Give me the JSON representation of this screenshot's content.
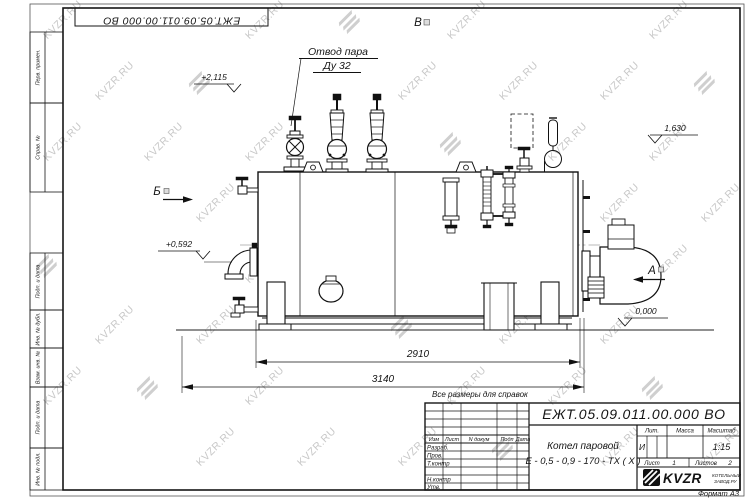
{
  "document": {
    "designation": "ЕЖТ.05.09.011.00.000  ВО",
    "product_name_line1": "Котел паровой",
    "product_name_line2": "Е - 0,5 - 0,9 - 170 -  ТХ ( Х )",
    "reference_note": "Все размеры для справок",
    "format_label": "Формат А3",
    "liter": "И",
    "scale": "1:15",
    "sheet_label": "Лист",
    "sheet_value": "1",
    "sheets_label": "Листов",
    "sheets_value": "2"
  },
  "title_block": {
    "lit_header": "Лит.",
    "mass_header": "Масса",
    "scale_header": "Масштаб",
    "columns": [
      "Изм",
      "Лист",
      "N докум",
      "Подп",
      "Дата"
    ],
    "rows": [
      "Разраб.",
      "Пров.",
      "Т.контр",
      "Н.контр",
      "Утв."
    ],
    "company_name": "KVZR",
    "company_caption_line1": "КОТЕЛЬНЫЙ",
    "company_caption_line2": "ЗАВОД.РУ"
  },
  "margin_labels": [
    "Перв. примен.",
    "Справ. №",
    "Подп. и дата",
    "Инв. № дубл.",
    "Взам. инв. №",
    "Подп. и дата",
    "Инв. № подл."
  ],
  "drawing": {
    "callout": {
      "line1": "Отвод пара",
      "line2": "Ду 32"
    },
    "views": {
      "top": "В",
      "left": "Б",
      "right": "А"
    },
    "elevations": {
      "valve_top": "+2,115",
      "shell_top": "1,630",
      "left_fitting": "+0,592",
      "ground": "0,000"
    },
    "dimensions": {
      "shell_length": "2910",
      "overall_length": "3140"
    }
  },
  "watermark": {
    "text": "KVZR.RU"
  }
}
